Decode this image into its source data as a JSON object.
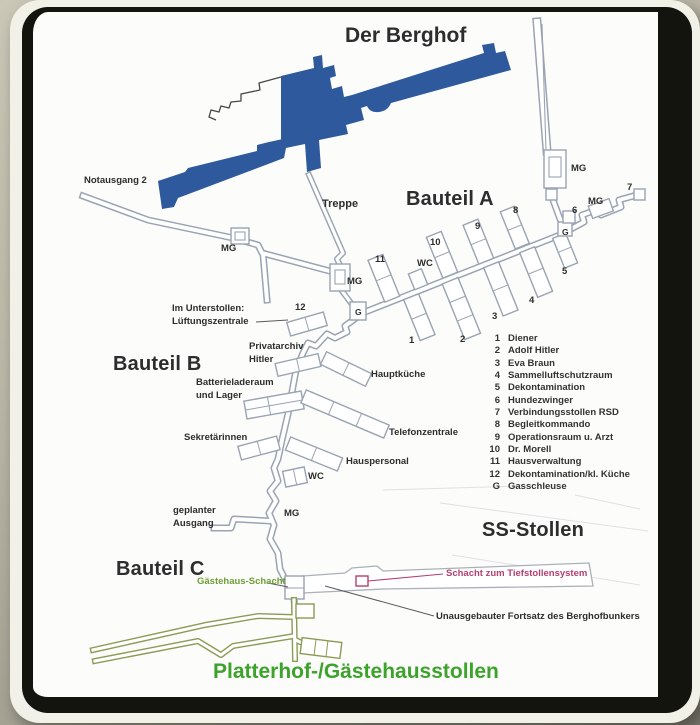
{
  "colors": {
    "building": "#2e5a9d",
    "corridor": "#9aa3b2",
    "green": "#8a9b55",
    "greenText": "#3da32c",
    "oliveText": "#6f9f35",
    "pink": "#b5406f",
    "ink": "#2d2d2d"
  },
  "title": "Der Berghof",
  "sections": {
    "bauteil_a": "Bauteil A",
    "bauteil_b": "Bauteil B",
    "bauteil_c": "Bauteil C",
    "ss_stollen": "SS-Stollen",
    "platterhof": "Platterhof-/Gästehausstollen"
  },
  "labels": {
    "notausgang": "Notausgang 2",
    "treppe": "Treppe",
    "im_unterstollen_1": "Im Unterstollen:",
    "im_unterstollen_2": "Lüftungszentrale",
    "privatarchiv_1": "Privatarchiv",
    "privatarchiv_2": "Hitler",
    "batterie_1": "Batterieladeraum",
    "batterie_2": "und Lager",
    "hauptkueche": "Hauptküche",
    "telefonzentrale": "Telefonzentrale",
    "sekretaerinnen": "Sekretärinnen",
    "hauspersonal": "Hauspersonal",
    "wc": "WC",
    "geplanter_1": "geplanter",
    "geplanter_2": "Ausgang",
    "gaestehaus_schacht": "Gästehaus-Schacht",
    "schacht_tiefstollen": "Schacht zum Tiefstollensystem",
    "unausgebauter": "Unausgebauter Fortsatz des Berghofbunkers",
    "mg": "MG",
    "g": "G"
  },
  "rooms": {
    "n1": "1",
    "n2": "2",
    "n3": "3",
    "n4": "4",
    "n5": "5",
    "n6": "6",
    "n7": "7",
    "n8": "8",
    "n9": "9",
    "n10": "10",
    "n11": "11",
    "n12": "12"
  },
  "legend": {
    "items": [
      {
        "num": "1",
        "label": "Diener"
      },
      {
        "num": "2",
        "label": "Adolf Hitler"
      },
      {
        "num": "3",
        "label": "Eva Braun"
      },
      {
        "num": "4",
        "label": "Sammelluftschutzraum"
      },
      {
        "num": "5",
        "label": "Dekontamination"
      },
      {
        "num": "6",
        "label": "Hundezwinger"
      },
      {
        "num": "7",
        "label": "Verbindungsstollen RSD"
      },
      {
        "num": "8",
        "label": "Begleitkommando"
      },
      {
        "num": "9",
        "label": "Operationsraum u. Arzt"
      },
      {
        "num": "10",
        "label": "Dr. Morell"
      },
      {
        "num": "11",
        "label": "Hausverwaltung"
      },
      {
        "num": "12",
        "label": "Dekontamination/kl. Küche"
      },
      {
        "num": "G",
        "label": "Gasschleuse"
      }
    ]
  }
}
